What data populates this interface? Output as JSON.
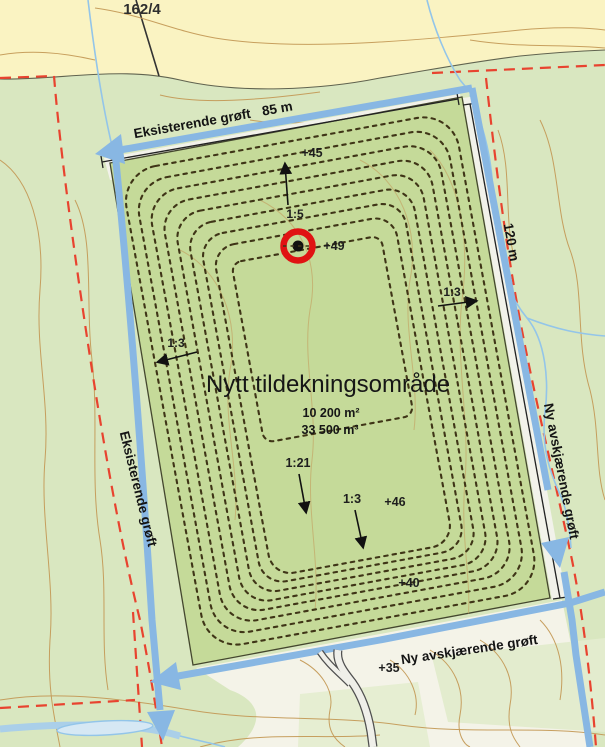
{
  "map": {
    "parcel_label": "162/4",
    "site": {
      "title": "Nytt tildekningsområde",
      "area": "10 200 m²",
      "volume": "33 500 m³"
    },
    "dimensions": {
      "top": "85 m",
      "right": "120 m"
    },
    "ditches": {
      "existing_top": "Eksisterende grøft",
      "existing_left": "Eksisterende grøft",
      "new_right": "Ny avskjærende grøft",
      "new_bottom": "Ny avskjærende grøft"
    },
    "elevations": {
      "e45": "+45",
      "e49": "+49",
      "e46": "+46",
      "e40": "+40",
      "e35": "+35"
    },
    "slopes": {
      "s_top": "1:5",
      "s_left": "1:3",
      "s_center": "1:21",
      "s_bottom": "1:3",
      "s_right": "1:3"
    },
    "colors": {
      "field": "#faf3c2",
      "forest": "#d9e7c0",
      "open_ground": "#f4f3e8",
      "site_fill": "#c5da99",
      "ditch_blue": "#88b7e3",
      "boundary_red": "#e8432f",
      "contour_brown": "#c49a57",
      "marker_red": "#e01313"
    }
  }
}
